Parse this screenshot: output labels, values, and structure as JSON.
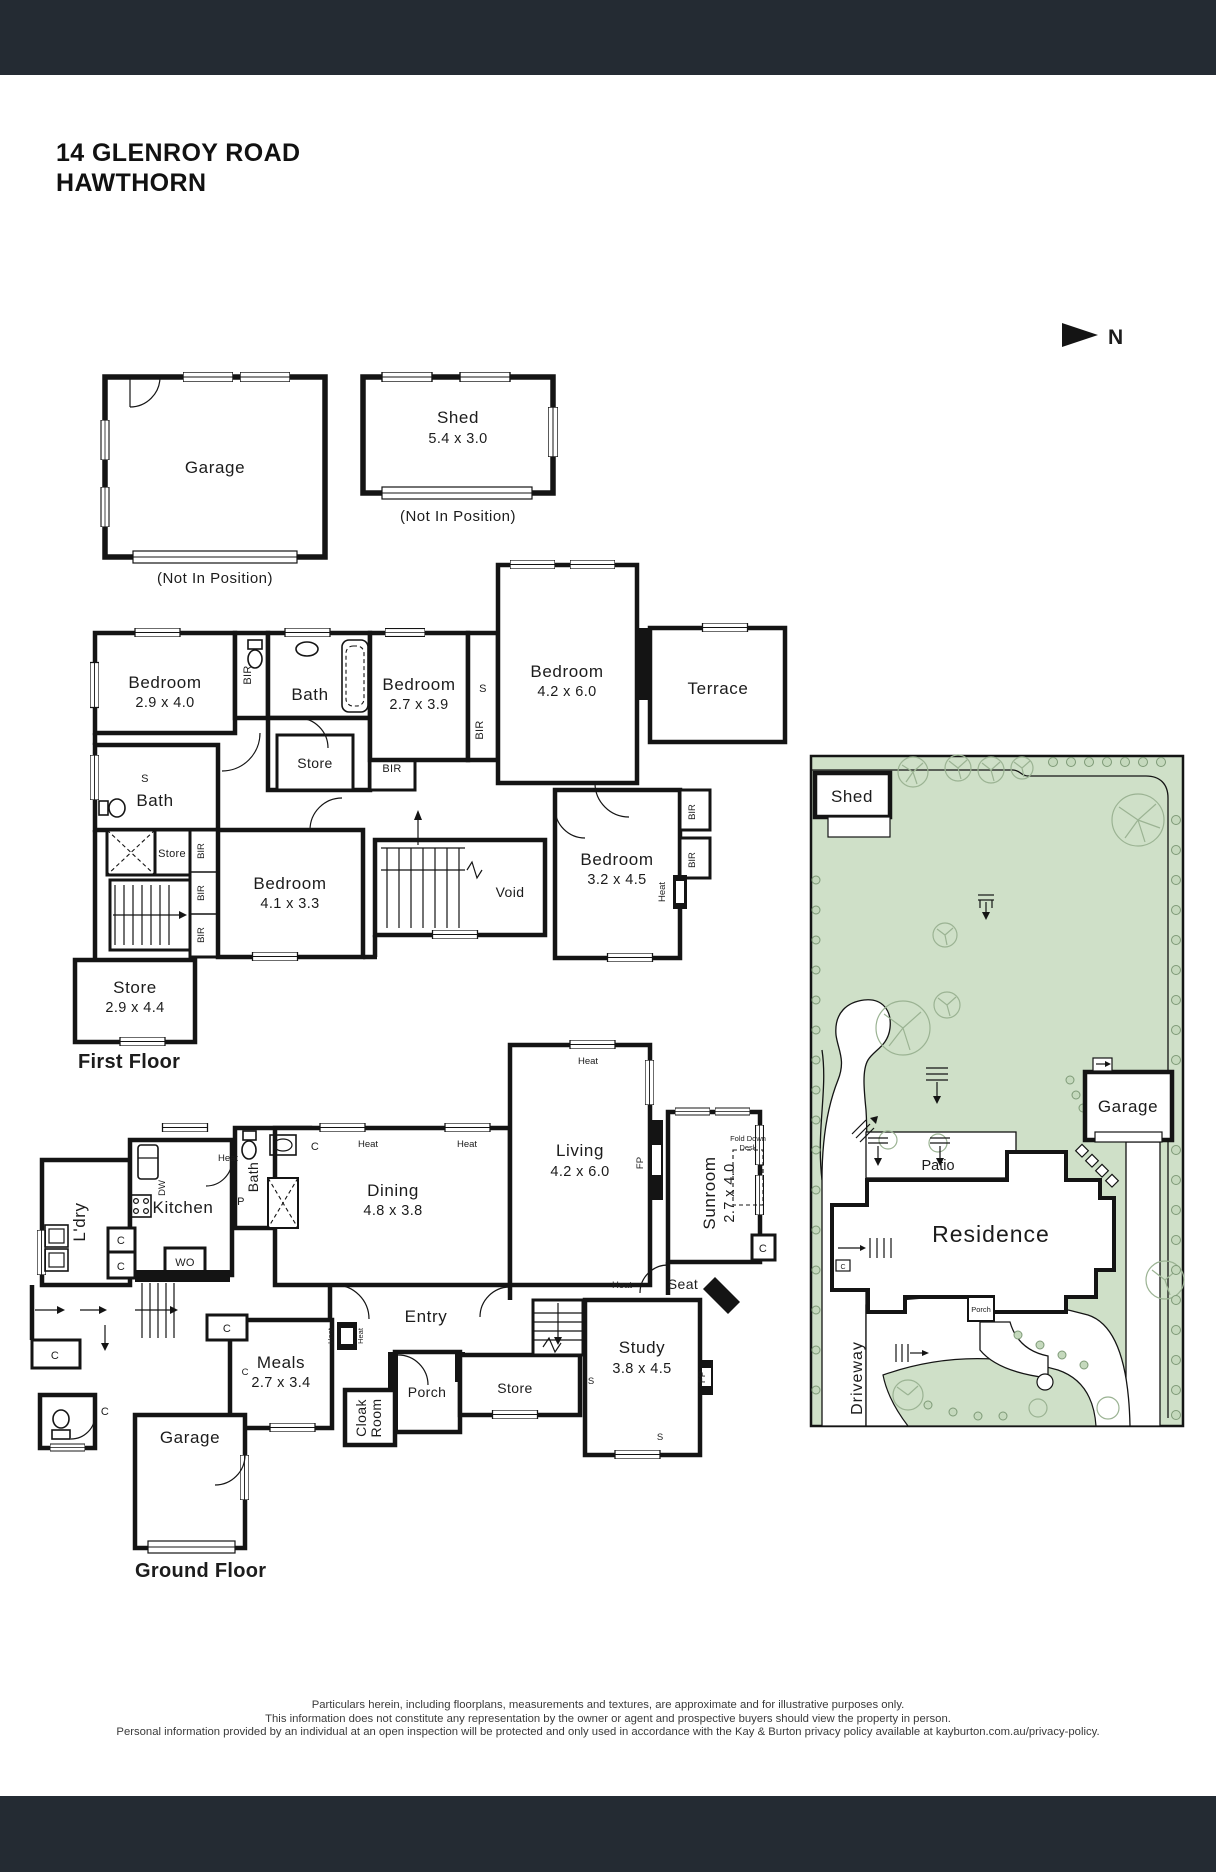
{
  "header": {
    "title_line1": "14 GLENROY ROAD",
    "title_line2": "HAWTHORN",
    "north": "N"
  },
  "outbuildings": {
    "garage": {
      "name": "Garage",
      "note": "(Not In Position)"
    },
    "shed": {
      "name": "Shed",
      "dims": "5.4 x 3.0",
      "note": "(Not In Position)"
    }
  },
  "tags": {
    "bir": "BIR",
    "s": "S",
    "c": "C",
    "heat": "Heat",
    "wo": "WO",
    "dw": "DW",
    "p": "P",
    "fp": "FP"
  },
  "first_floor": {
    "title": "First Floor",
    "rooms": {
      "bed1": {
        "name": "Bedroom",
        "dims": "2.9 x 4.0"
      },
      "bath_top": {
        "name": "Bath"
      },
      "store_top": {
        "name": "Store"
      },
      "bed2": {
        "name": "Bedroom",
        "dims": "2.7 x 3.9"
      },
      "bed3": {
        "name": "Bedroom",
        "dims": "4.2 x 6.0"
      },
      "terrace": {
        "name": "Terrace"
      },
      "bath_left": {
        "name": "Bath"
      },
      "store_mid": {
        "name": "Store"
      },
      "bed4": {
        "name": "Bedroom",
        "dims": "4.1 x 3.3"
      },
      "void": {
        "name": "Void"
      },
      "bed5": {
        "name": "Bedroom",
        "dims": "3.2 x 4.5"
      },
      "store_lower": {
        "name": "Store",
        "dims": "2.9 x 4.4"
      }
    }
  },
  "ground_floor": {
    "title": "Ground Floor",
    "rooms": {
      "kitchen": {
        "name": "Kitchen"
      },
      "ldry": {
        "name": "L'dry"
      },
      "bath": {
        "name": "Bath"
      },
      "dining": {
        "name": "Dining",
        "dims": "4.8 x 3.8"
      },
      "living": {
        "name": "Living",
        "dims": "4.2 x 6.0"
      },
      "sunroom": {
        "name": "Sunroom",
        "dims": "2.7 x 4.0"
      },
      "fold_desk": {
        "line1": "Fold Down",
        "line2": "Desk"
      },
      "seat": {
        "name": "Seat"
      },
      "entry": {
        "name": "Entry"
      },
      "study": {
        "name": "Study",
        "dims": "3.8 x 4.5"
      },
      "store": {
        "name": "Store"
      },
      "porch": {
        "name": "Porch"
      },
      "cloak": {
        "line1": "Cloak",
        "line2": "Room"
      },
      "meals": {
        "name": "Meals",
        "dims": "2.7 x 3.4"
      },
      "garage": {
        "name": "Garage"
      }
    }
  },
  "site_plan": {
    "shed": "Shed",
    "garage": "Garage",
    "patio": "Patio",
    "residence": "Residence",
    "porch": "Porch",
    "driveway": "Driveway"
  },
  "footer": {
    "line1": "Particulars herein, including floorplans, measurements and textures, are approximate and for illustrative purposes only.",
    "line2": "This information does not constitute any representation by the owner or agent and prospective buyers should view the property in person.",
    "line3": "Personal information provided by an individual at an open inspection will be protected and only used in accordance with the Kay & Burton privacy policy available at kayburton.com.au/privacy-policy."
  },
  "colors": {
    "band": "#242b33",
    "site_green": "#cfe0c8",
    "wall": "#141414"
  }
}
